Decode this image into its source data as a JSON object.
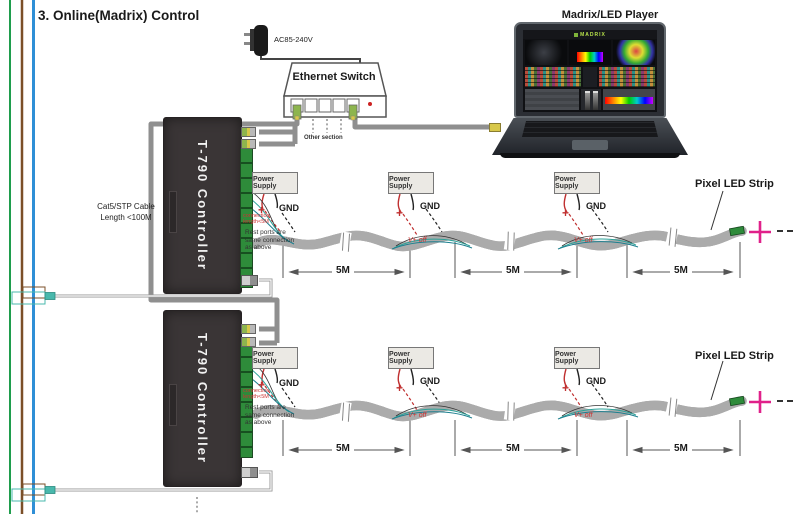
{
  "title": "3. Online(Madrix) Control",
  "adapter": {
    "label": "AC85-240V"
  },
  "ethernet_switch": {
    "label": "Ethernet Switch",
    "other_section": "Other section"
  },
  "laptop": {
    "label": "Madrix/LED Player",
    "software_logo": "MADRIX"
  },
  "controller": {
    "name": "T-790 Controller"
  },
  "cable_note": {
    "line1": "Cat5/STP Cable",
    "line2": "Length <100M"
  },
  "power_supply": {
    "label": "Power Supply"
  },
  "wiring": {
    "gnd": "GND",
    "plus": "+",
    "v_plus_off": "V+ off",
    "lead_note_line1": "connection",
    "lead_note_line2": "length<5M",
    "rest_note_line1": "Rest ports are",
    "rest_note_line2": "same connection",
    "rest_note_line3": "as above"
  },
  "strip": {
    "label": "Pixel LED Strip",
    "segment_length": "5M"
  },
  "colors": {
    "bus_green": "#1f9d4d",
    "bus_brown": "#7b4f28",
    "bus_blue": "#2f8fd6",
    "cable_gray": "#8f8f8f",
    "wire_red": "#c03030",
    "wire_teal": "#2aa198",
    "strip_end_magenta": "#e0218a",
    "controller_body": "#3a3536",
    "terminal_green": "#2e8b3a"
  }
}
